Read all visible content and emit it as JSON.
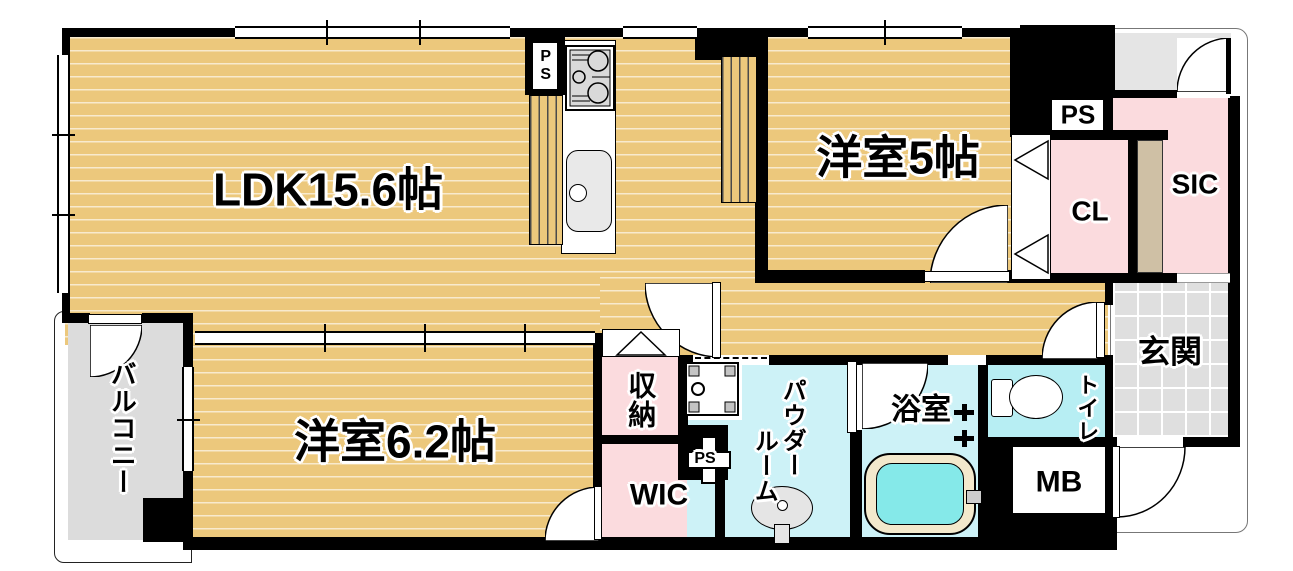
{
  "title": "マンション間取り図",
  "colors": {
    "wood": "#ecc87c",
    "pink": "#fbdbde",
    "powderCyan": "#cdf2f7",
    "toiletCyan": "#b7eef3",
    "bathWater": "#85e9e9",
    "tubRim": "#f3e9cc",
    "genkanGray": "#dfdfdf",
    "balconyGray": "#dcdcdc",
    "porchGray": "#e5e5e5",
    "cabinetBeige": "#cfc0a5",
    "wall": "#000000"
  },
  "labels": {
    "ldk": "LDK15.6帖",
    "bed5": "洋室5帖",
    "bed62": "洋室6.2帖",
    "cl": "CL",
    "sic": "SIC",
    "psTop": "PS",
    "psKitchen": "PS",
    "psHall": "PS",
    "genkan": "玄関",
    "balcony": "バルコニー",
    "storage": "収納",
    "wic": "WIC",
    "powder1": "パウダー",
    "powder2": "ルーム",
    "bath": "浴室",
    "toilet": "トイレ",
    "mb": "MB"
  }
}
